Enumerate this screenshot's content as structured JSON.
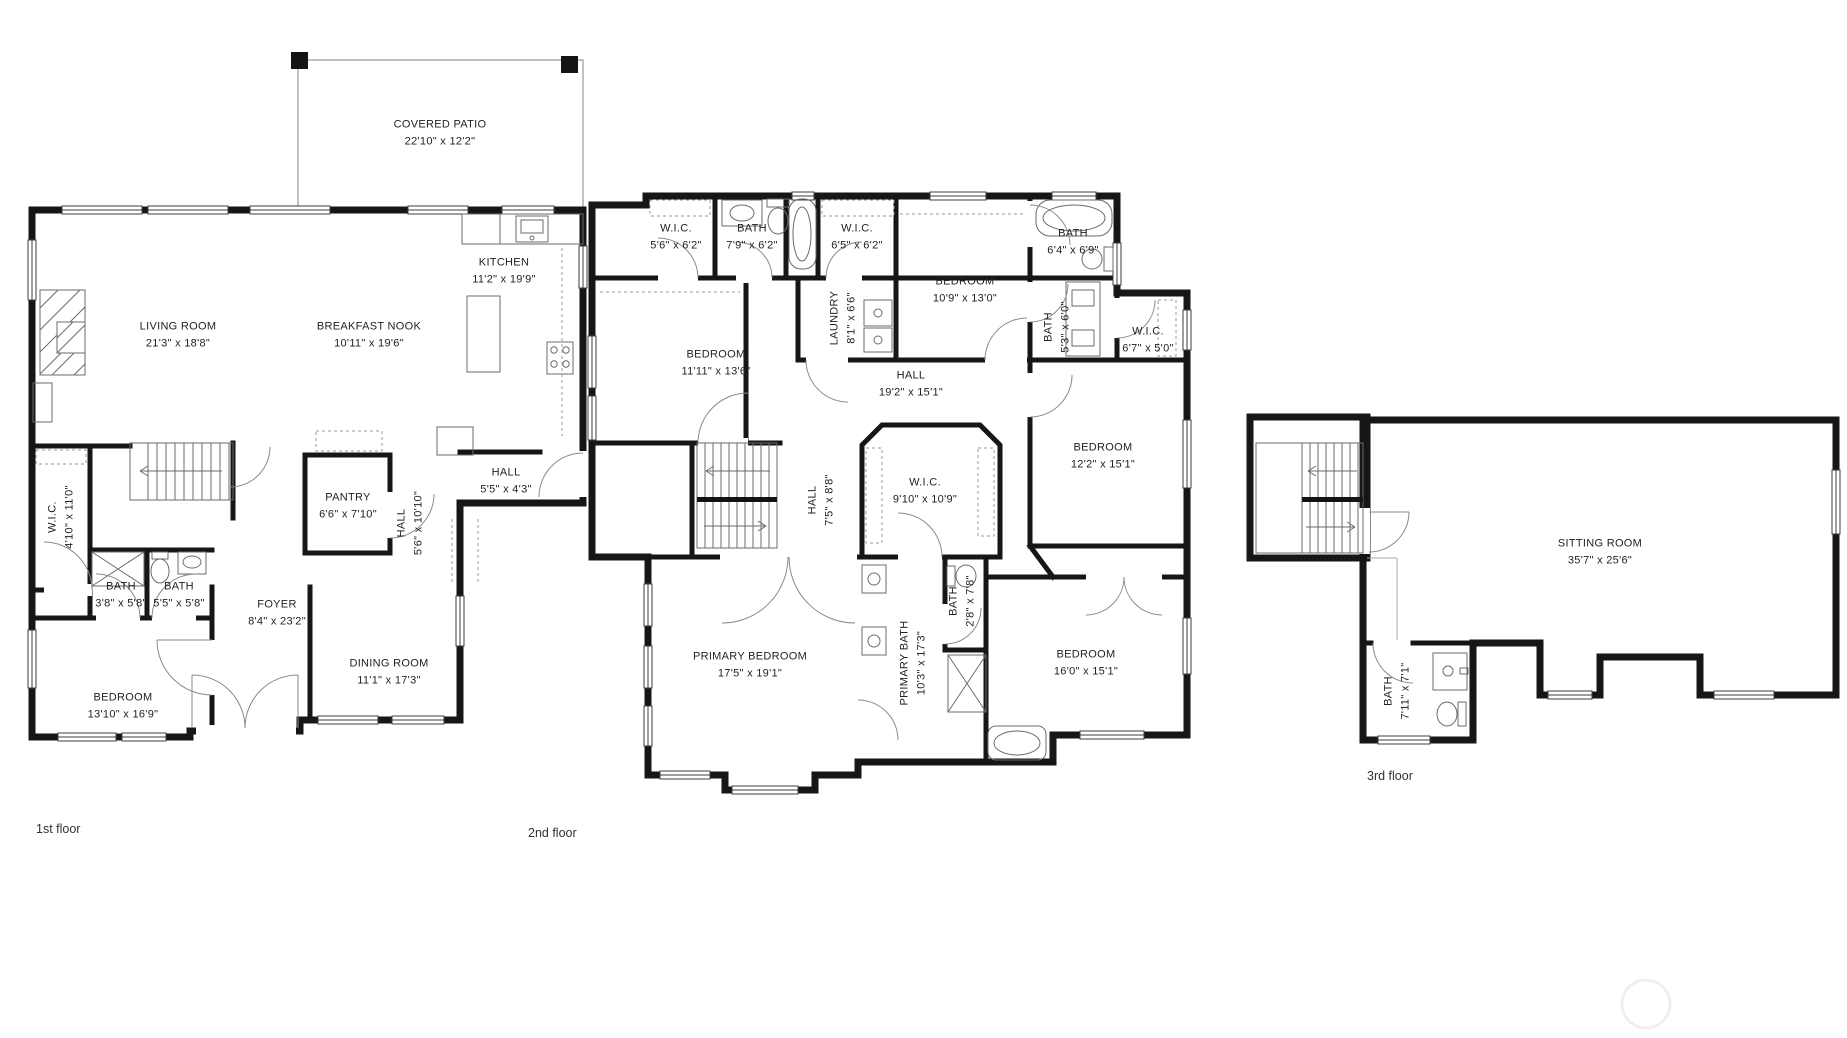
{
  "page": {
    "background": "#ffffff",
    "wall_color": "#161616",
    "thin_line_color": "#8a8a8a"
  },
  "watermark": {
    "shape": "circle",
    "color": "#efefef"
  },
  "floors": [
    {
      "id": "first",
      "caption": "1st floor",
      "caption_pos": {
        "x": 36,
        "y": 822
      },
      "rooms": [
        {
          "name": "COVERED PATIO",
          "dims": "22'10\" x 12'2\"",
          "x": 440,
          "y": 133,
          "vertical": false
        },
        {
          "name": "LIVING ROOM",
          "dims": "21'3\" x 18'8\"",
          "x": 178,
          "y": 335,
          "vertical": false
        },
        {
          "name": "BREAKFAST NOOK",
          "dims": "10'11\" x 19'6\"",
          "x": 369,
          "y": 335,
          "vertical": false
        },
        {
          "name": "KITCHEN",
          "dims": "11'2\" x 19'9\"",
          "x": 504,
          "y": 271,
          "vertical": false
        },
        {
          "name": "W.I.C.",
          "dims": "4'10\" x 11'0\"",
          "x": 61,
          "y": 517,
          "vertical": true
        },
        {
          "name": "PANTRY",
          "dims": "6'6\" x 7'10\"",
          "x": 348,
          "y": 506,
          "vertical": false
        },
        {
          "name": "HALL",
          "dims": "5'6\" x 10'10\"",
          "x": 410,
          "y": 523,
          "vertical": true
        },
        {
          "name": "HALL",
          "dims": "5'5\" x 4'3\"",
          "x": 506,
          "y": 481,
          "vertical": false
        },
        {
          "name": "BATH",
          "dims": "3'8\" x 5'8\"",
          "x": 121,
          "y": 595,
          "vertical": false
        },
        {
          "name": "BATH",
          "dims": "5'5\" x 5'8\"",
          "x": 179,
          "y": 595,
          "vertical": false
        },
        {
          "name": "FOYER",
          "dims": "8'4\" x 23'2\"",
          "x": 277,
          "y": 613,
          "vertical": false
        },
        {
          "name": "DINING ROOM",
          "dims": "11'1\" x 17'3\"",
          "x": 389,
          "y": 672,
          "vertical": false
        },
        {
          "name": "BEDROOM",
          "dims": "13'10\" x 16'9\"",
          "x": 123,
          "y": 706,
          "vertical": false
        }
      ]
    },
    {
      "id": "second",
      "caption": "2nd floor",
      "caption_pos": {
        "x": 528,
        "y": 826
      },
      "rooms": [
        {
          "name": "W.I.C.",
          "dims": "5'6\" x 6'2\"",
          "x": 676,
          "y": 237,
          "vertical": false
        },
        {
          "name": "BATH",
          "dims": "7'9\" x 6'2\"",
          "x": 752,
          "y": 237,
          "vertical": false
        },
        {
          "name": "W.I.C.",
          "dims": "6'5\" x 6'2\"",
          "x": 857,
          "y": 237,
          "vertical": false
        },
        {
          "name": "BEDROOM",
          "dims": "10'9\" x 13'0\"",
          "x": 965,
          "y": 290,
          "vertical": false
        },
        {
          "name": "LAUNDRY",
          "dims": "8'1\" x 6'6\"",
          "x": 843,
          "y": 318,
          "vertical": true
        },
        {
          "name": "BEDROOM",
          "dims": "11'11\" x 13'6\"",
          "x": 716,
          "y": 363,
          "vertical": false
        },
        {
          "name": "HALL",
          "dims": "19'2\" x 15'1\"",
          "x": 911,
          "y": 384,
          "vertical": false
        },
        {
          "name": "BATH",
          "dims": "6'4\" x 6'9\"",
          "x": 1073,
          "y": 242,
          "vertical": false
        },
        {
          "name": "BATH",
          "dims": "5'3\" x 6'0\"",
          "x": 1057,
          "y": 327,
          "vertical": true
        },
        {
          "name": "W.I.C.",
          "dims": "6'7\" x 5'0\"",
          "x": 1148,
          "y": 340,
          "vertical": false
        },
        {
          "name": "BEDROOM",
          "dims": "12'2\" x 15'1\"",
          "x": 1103,
          "y": 456,
          "vertical": false
        },
        {
          "name": "HALL",
          "dims": "7'5\" x 8'8\"",
          "x": 821,
          "y": 500,
          "vertical": true
        },
        {
          "name": "W.I.C.",
          "dims": "9'10\" x 10'9\"",
          "x": 925,
          "y": 491,
          "vertical": false
        },
        {
          "name": "BATH",
          "dims": "2'8\" x 7'8\"",
          "x": 962,
          "y": 601,
          "vertical": true
        },
        {
          "name": "PRIMARY BEDROOM",
          "dims": "17'5\" x 19'1\"",
          "x": 750,
          "y": 665,
          "vertical": false
        },
        {
          "name": "PRIMARY BATH",
          "dims": "10'3\" x 17'3\"",
          "x": 913,
          "y": 663,
          "vertical": true
        },
        {
          "name": "BEDROOM",
          "dims": "16'0\" x 15'1\"",
          "x": 1086,
          "y": 663,
          "vertical": false
        }
      ]
    },
    {
      "id": "third",
      "caption": "3rd floor",
      "caption_pos": {
        "x": 1367,
        "y": 769
      },
      "rooms": [
        {
          "name": "SITTING ROOM",
          "dims": "35'7\" x 25'6\"",
          "x": 1600,
          "y": 552,
          "vertical": false
        },
        {
          "name": "BATH",
          "dims": "7'11\" x 7'1\"",
          "x": 1397,
          "y": 691,
          "vertical": true
        }
      ]
    }
  ]
}
